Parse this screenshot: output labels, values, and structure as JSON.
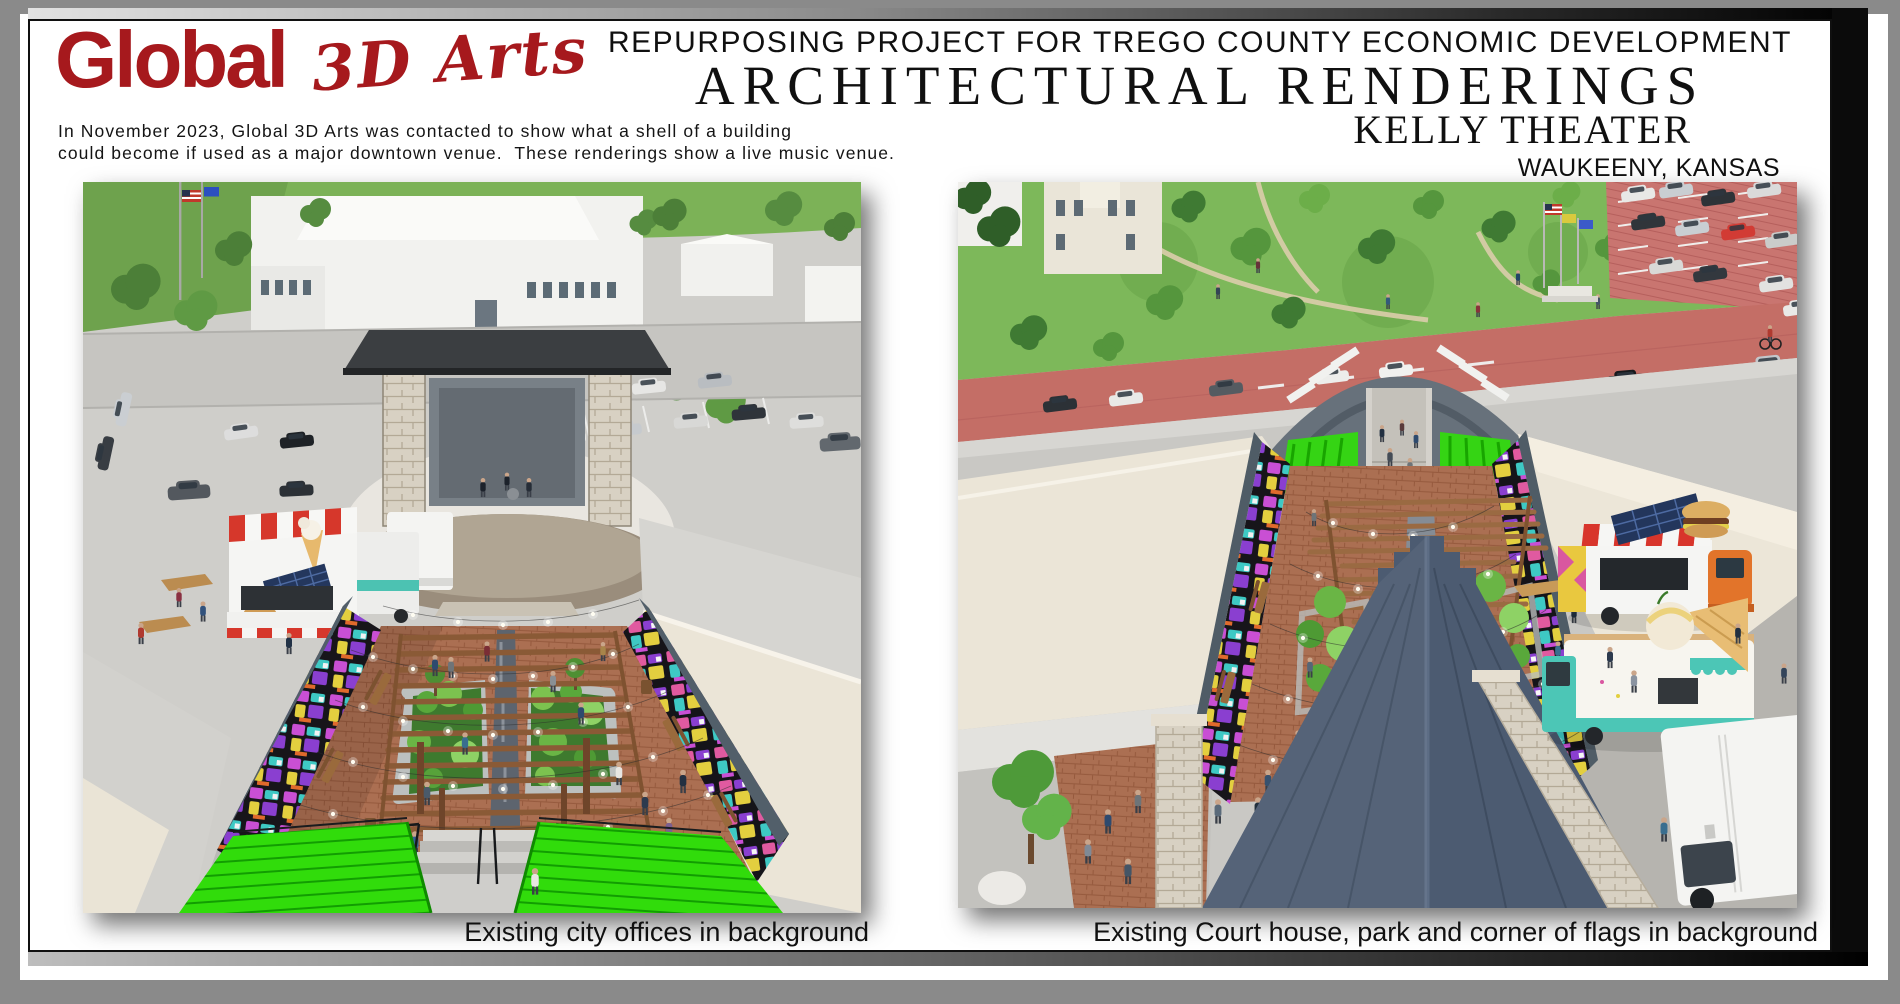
{
  "logo": {
    "brand": "Global",
    "sub": "3D Arts",
    "color": "#a6191d"
  },
  "header": {
    "project_line": "REPURPOSING PROJECT FOR TREGO COUNTY ECONOMIC DEVELOPMENT",
    "title": "ARCHITECTURAL RENDERINGS",
    "subtitle": "KELLY THEATER",
    "location": "WAUKEENY, KANSAS"
  },
  "intro": {
    "line1": "In November 2023, Global 3D Arts was contacted to show what a shell of a building",
    "line2": "could become if used as a major downtown venue.  These renderings show a live music venue."
  },
  "figures": {
    "left": {
      "caption": "Existing city offices in background"
    },
    "right": {
      "caption": "Existing Court house, park and corner of flags in background"
    }
  },
  "palette": {
    "brand_red": "#a6191d",
    "frame_black": "#0b0b0b",
    "outer_gray": "#8a8a8a",
    "bleacher_green": "#31dc0b",
    "mural_magenta": "#c94fd4",
    "mural_teal": "#3ec9c4",
    "brick": "#ab6f52",
    "canopy_slate": "#4c5b71",
    "roof_beige": "#ece6d8",
    "street_red": "#c46e66"
  }
}
